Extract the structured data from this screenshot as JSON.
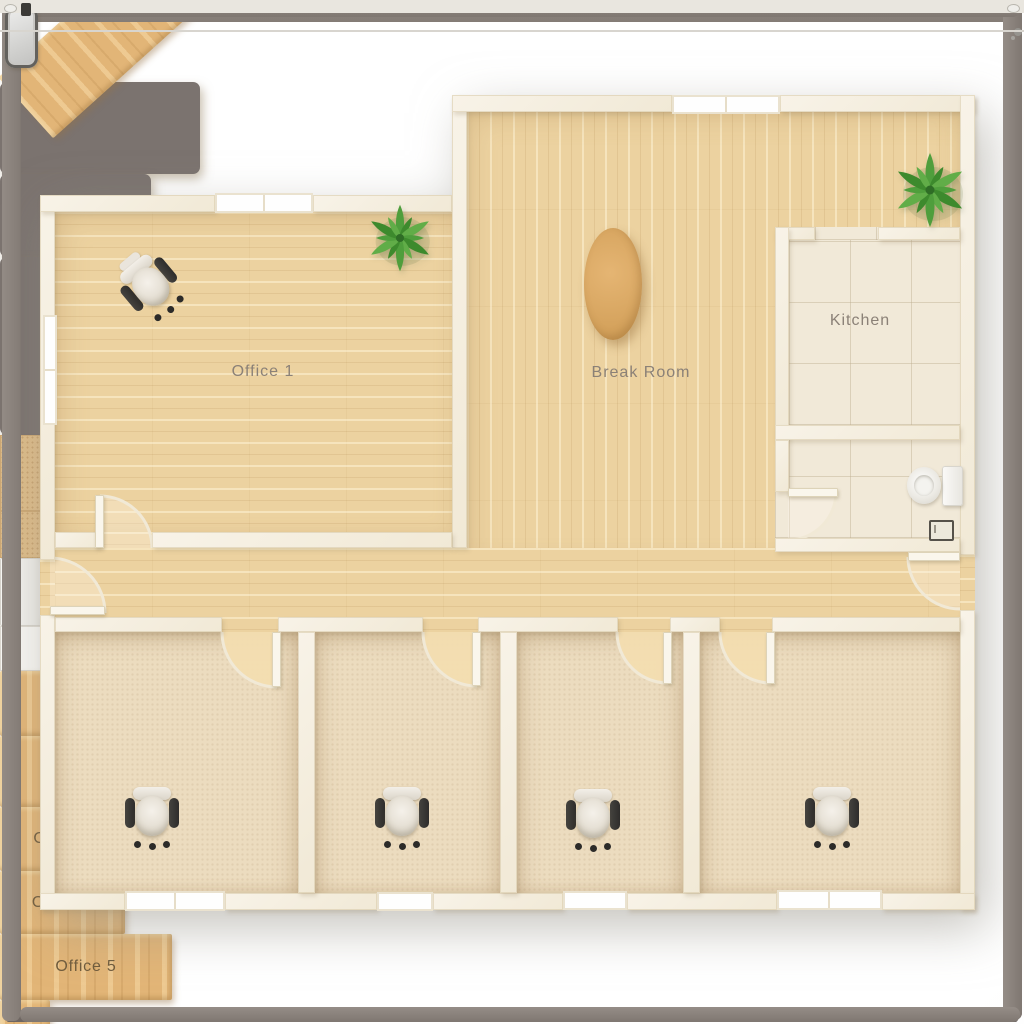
{
  "rooms": {
    "office1": {
      "label": "Office 1"
    },
    "break_room": {
      "label": "Break Room"
    },
    "kitchen": {
      "label": "Kitchen"
    },
    "office2": {
      "label": "Office 2"
    },
    "office3": {
      "label": "Office 3"
    },
    "office4": {
      "label": "Office 4"
    },
    "office5": {
      "label": "Office 5"
    }
  },
  "colors": {
    "wood_floor": "#ecd2a0",
    "carpet_floor": "#ecdcbf",
    "tile_floor": "#f1e9d8",
    "wall": "#f5efe1",
    "desk_wood": "#e2b577",
    "sofa_gray": "#7b736f",
    "plant_green": "#4f9e3c",
    "room_label": "#8b8177",
    "desk_label": "#6f5b3c"
  }
}
